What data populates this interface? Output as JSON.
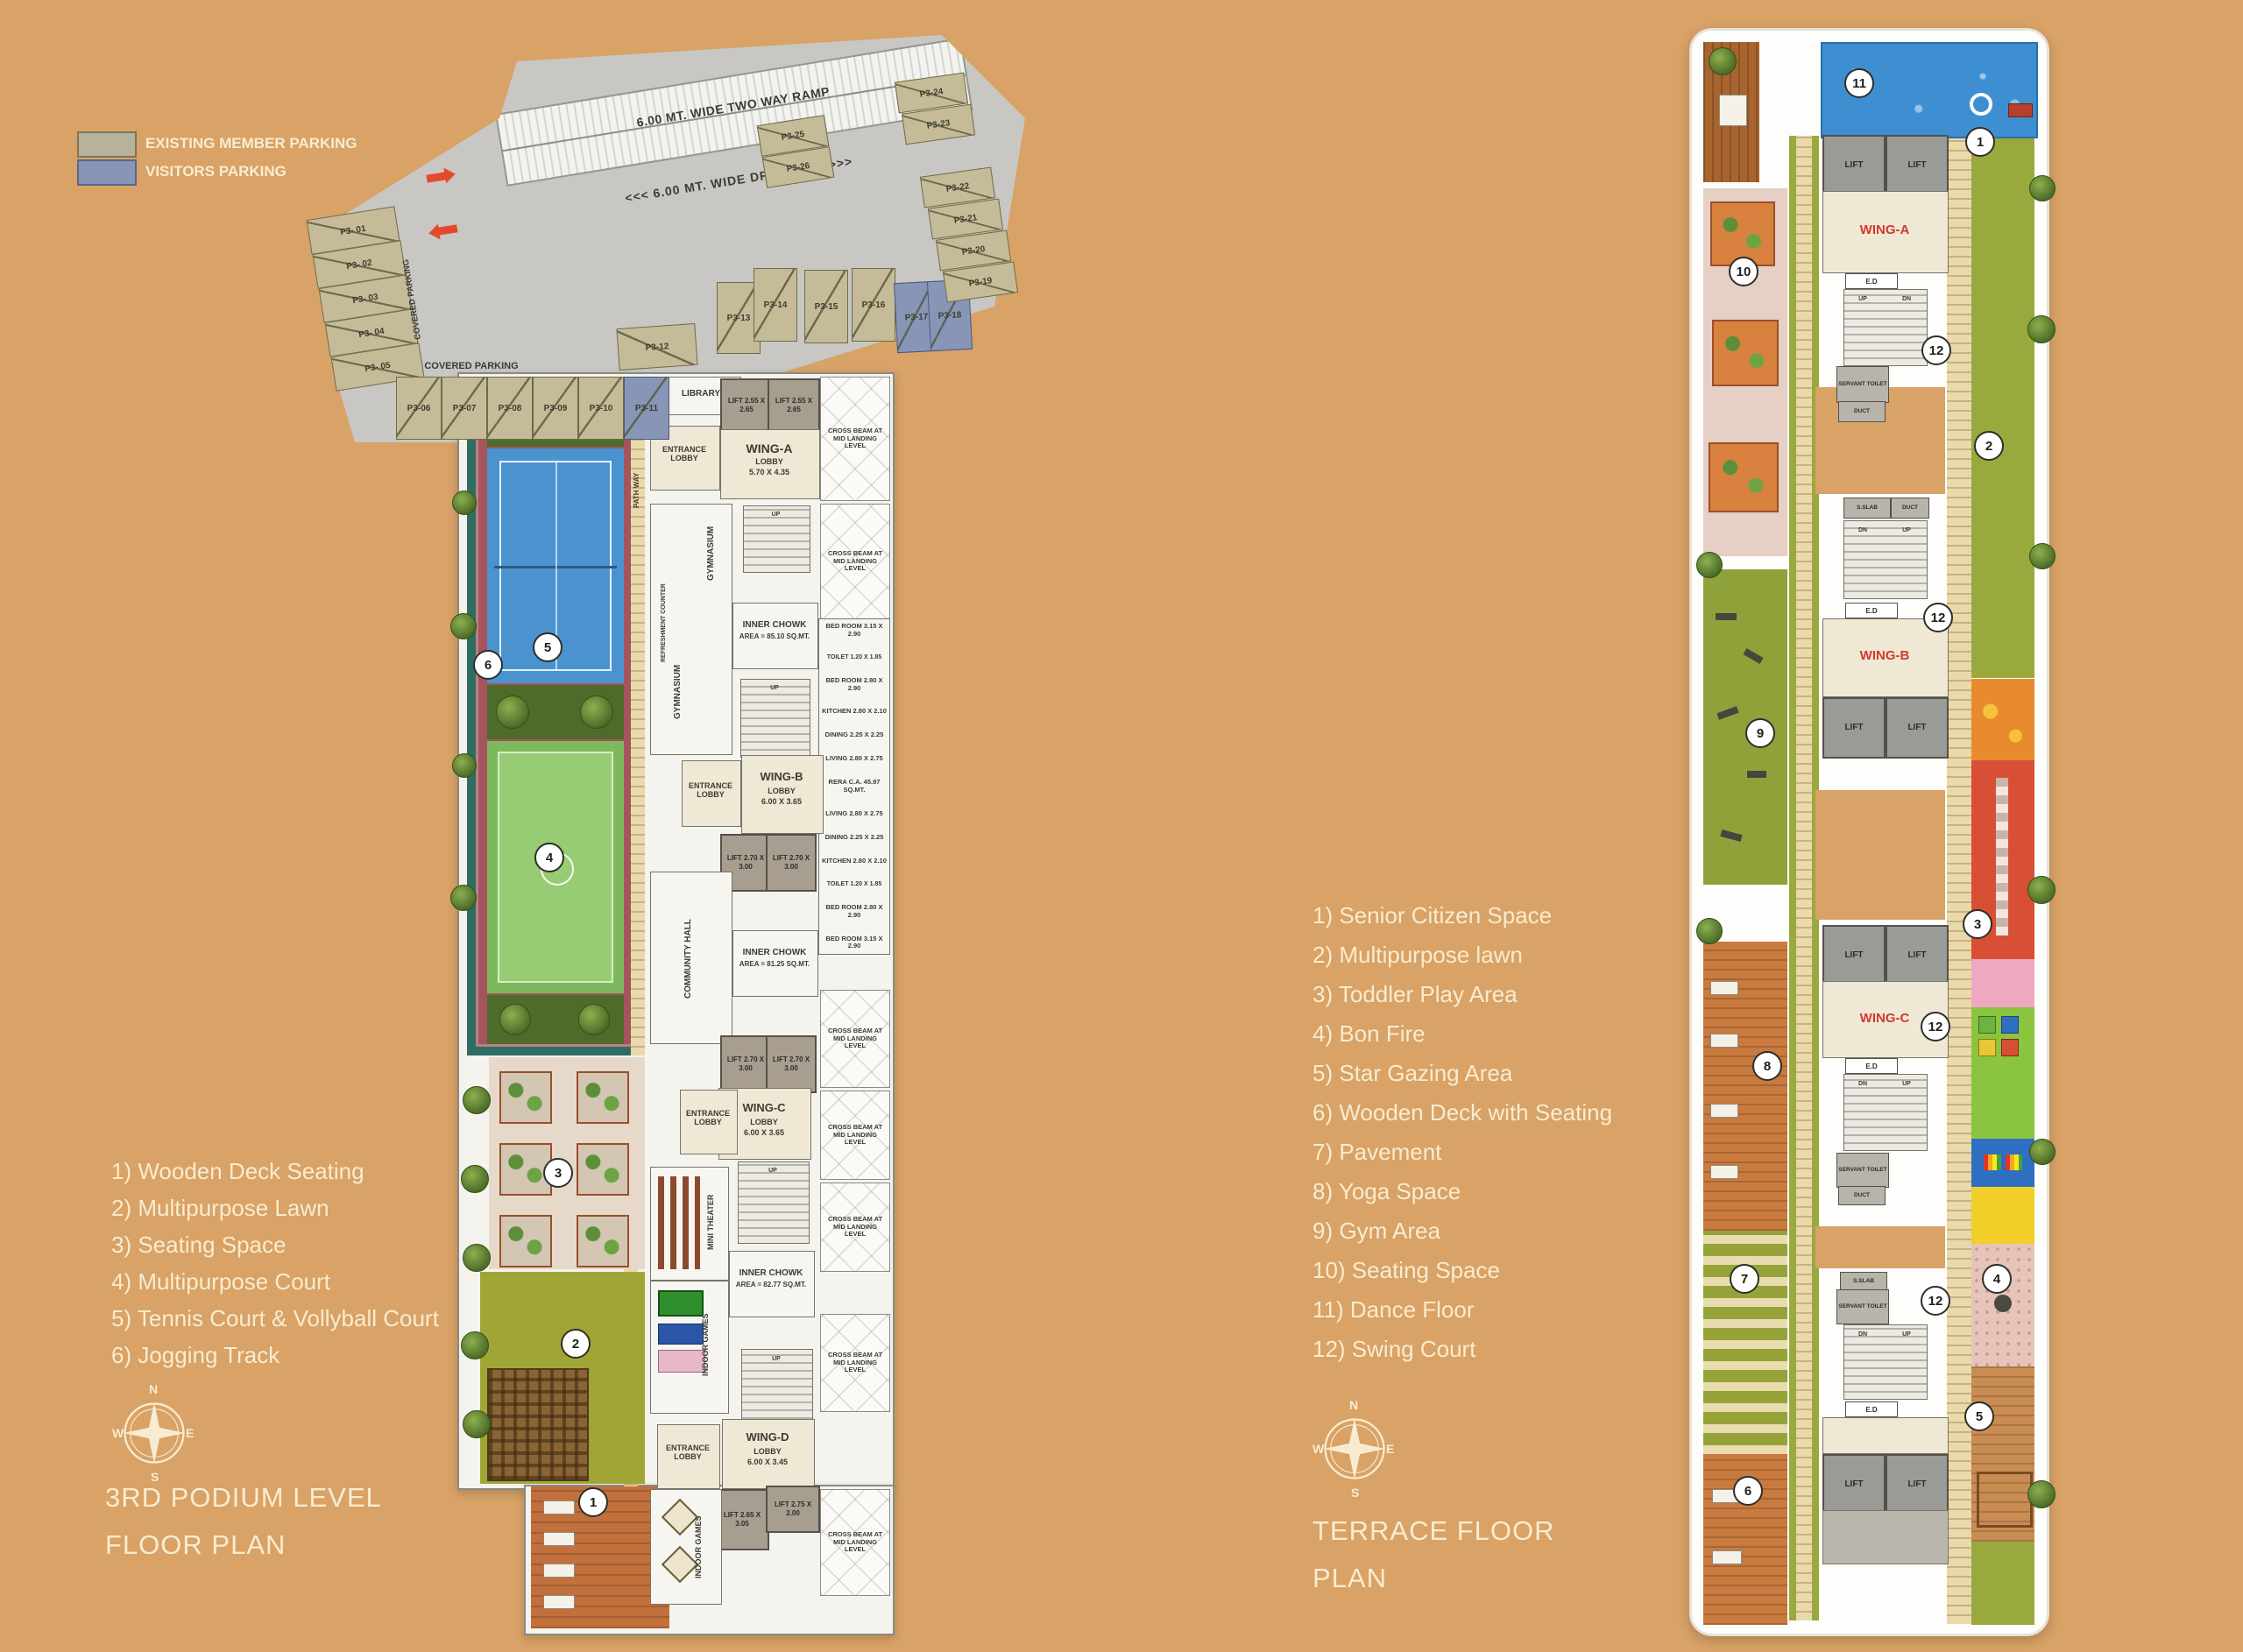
{
  "colors": {
    "background": "#d9a266",
    "member_parking_swatch": "#b7b29b",
    "visitors_parking_swatch": "#8796b6",
    "wing_label_red": "#cf3a2e",
    "cream_text": "#f8ecd0"
  },
  "parking_legend": [
    {
      "label": "EXISTING MEMBER PARKING"
    },
    {
      "label": "VISITORS PARKING"
    }
  ],
  "compass": {
    "n": "N",
    "e": "E",
    "s": "S",
    "w": "W"
  },
  "podium": {
    "title1": "3RD PODIUM LEVEL",
    "title2": "FLOOR PLAN",
    "legend": [
      "1) Wooden Deck Seating",
      "2) Multipurpose Lawn",
      "3) Seating Space",
      "4) Multipurpose Court",
      "5) Tennis Court & Vollyball Court",
      "6) Jogging Track"
    ],
    "markers": [
      "1",
      "2",
      "3",
      "4",
      "5",
      "6"
    ],
    "parking": {
      "ramp": "6.00 MT. WIDE TWO WAY RAMP",
      "driveway": "<<< 6.00 MT. WIDE DRIVE WAY >>>",
      "covered": "COVERED PARKING",
      "spots_left": [
        "P3- 01",
        "P3- 02",
        "P3- 03",
        "P3- 04",
        "P3- 05"
      ],
      "spots_row": [
        "P3-06",
        "P3-07",
        "P3-08",
        "P3-09",
        "P3-10",
        "P3-11"
      ],
      "spots_mid": [
        "P3-12",
        "P3-13",
        "P3-14",
        "P3-15",
        "P3-16",
        "P3-17",
        "P3-18"
      ],
      "spots_right": [
        "P3-19",
        "P3-20",
        "P3-21",
        "P3-22",
        "P3-23",
        "P3-24",
        "P3-25",
        "P3-26"
      ]
    },
    "rooms": {
      "library": "LIBRARY",
      "entrance_lobby": "ENTRANCE LOBBY",
      "wing_a": "WING-A",
      "wing_a_sub": "LOBBY",
      "wing_a_dim": "5.70 X 4.35",
      "wing_b": "WING-B",
      "wing_b_sub": "LOBBY",
      "wing_b_dim": "6.00 X 3.65",
      "wing_c": "WING-C",
      "wing_c_sub": "LOBBY",
      "wing_c_dim": "6.00 X 3.65",
      "wing_d": "WING-D",
      "wing_d_sub": "LOBBY",
      "wing_d_dim": "6.00 X 3.45",
      "lift_a": "LIFT 2.55 X 2.65",
      "lift_b": "LIFT 2.70 X 3.00",
      "lift_c": "LIFT 2.70 X 3.00",
      "lift_d1": "LIFT 2.65 X 3.05",
      "lift_d2": "LIFT 2.75 X 2.00",
      "gymnasium": "GYMNASIUM",
      "refreshment": "REFRESHMENT COUNTER",
      "path_way": "PATH WAY",
      "community_hall": "COMMUNITY HALL",
      "mini_theater": "MINI THEATER",
      "indoor_games": "INDOOR GAMES",
      "chowk1a": "INNER CHOWK",
      "chowk1b": "AREA = 85.10 SQ.MT.",
      "chowk2a": "INNER CHOWK",
      "chowk2b": "AREA = 81.25 SQ.MT.",
      "chowk3a": "INNER CHOWK",
      "chowk3b": "AREA = 82.77 SQ.MT.",
      "cross_beam": "CROSS BEAM AT MID LANDING LEVEL",
      "up": "UP",
      "units": [
        "BED ROOM 3.15 X 2.90",
        "TOILET 1.20 X 1.85",
        "BED ROOM 2.80 X 2.90",
        "KITCHEN 2.80 X 2.10",
        "DINING 2.25 X 2.25",
        "LIVING 2.80 X 2.75",
        "RERA C.A. 45.97 SQ.MT.",
        "LIVING 2.80 X 2.75",
        "DINING 2.25 X 2.25",
        "KITCHEN 2.80 X 2.10",
        "TOILET 1.20 X 1.85",
        "BED ROOM 2.80 X 2.90",
        "BED ROOM 3.15 X 2.90"
      ]
    }
  },
  "terrace": {
    "title1": "TERRACE FLOOR",
    "title2": "PLAN",
    "legend": [
      "1) Senior Citizen Space",
      "2) Multipurpose lawn",
      "3) Toddler Play Area",
      "4) Bon Fire",
      "5) Star Gazing Area",
      "6) Wooden Deck with Seating",
      "7) Pavement",
      "8) Yoga Space",
      "9) Gym Area",
      "10) Seating Space",
      "11) Dance Floor",
      "12) Swing Court"
    ],
    "markers": [
      "1",
      "2",
      "3",
      "4",
      "5",
      "6",
      "7",
      "8",
      "9",
      "10",
      "11",
      "12"
    ],
    "wing_a": "WING-A",
    "wing_b": "WING-B",
    "wing_c": "WING-C",
    "lift": "LIFT",
    "ed": "E.D",
    "up": "UP",
    "dn": "DN",
    "servant_toilet": "SERVANT TOILET",
    "duct": "DUCT",
    "s_slab": "S.SLAB"
  }
}
